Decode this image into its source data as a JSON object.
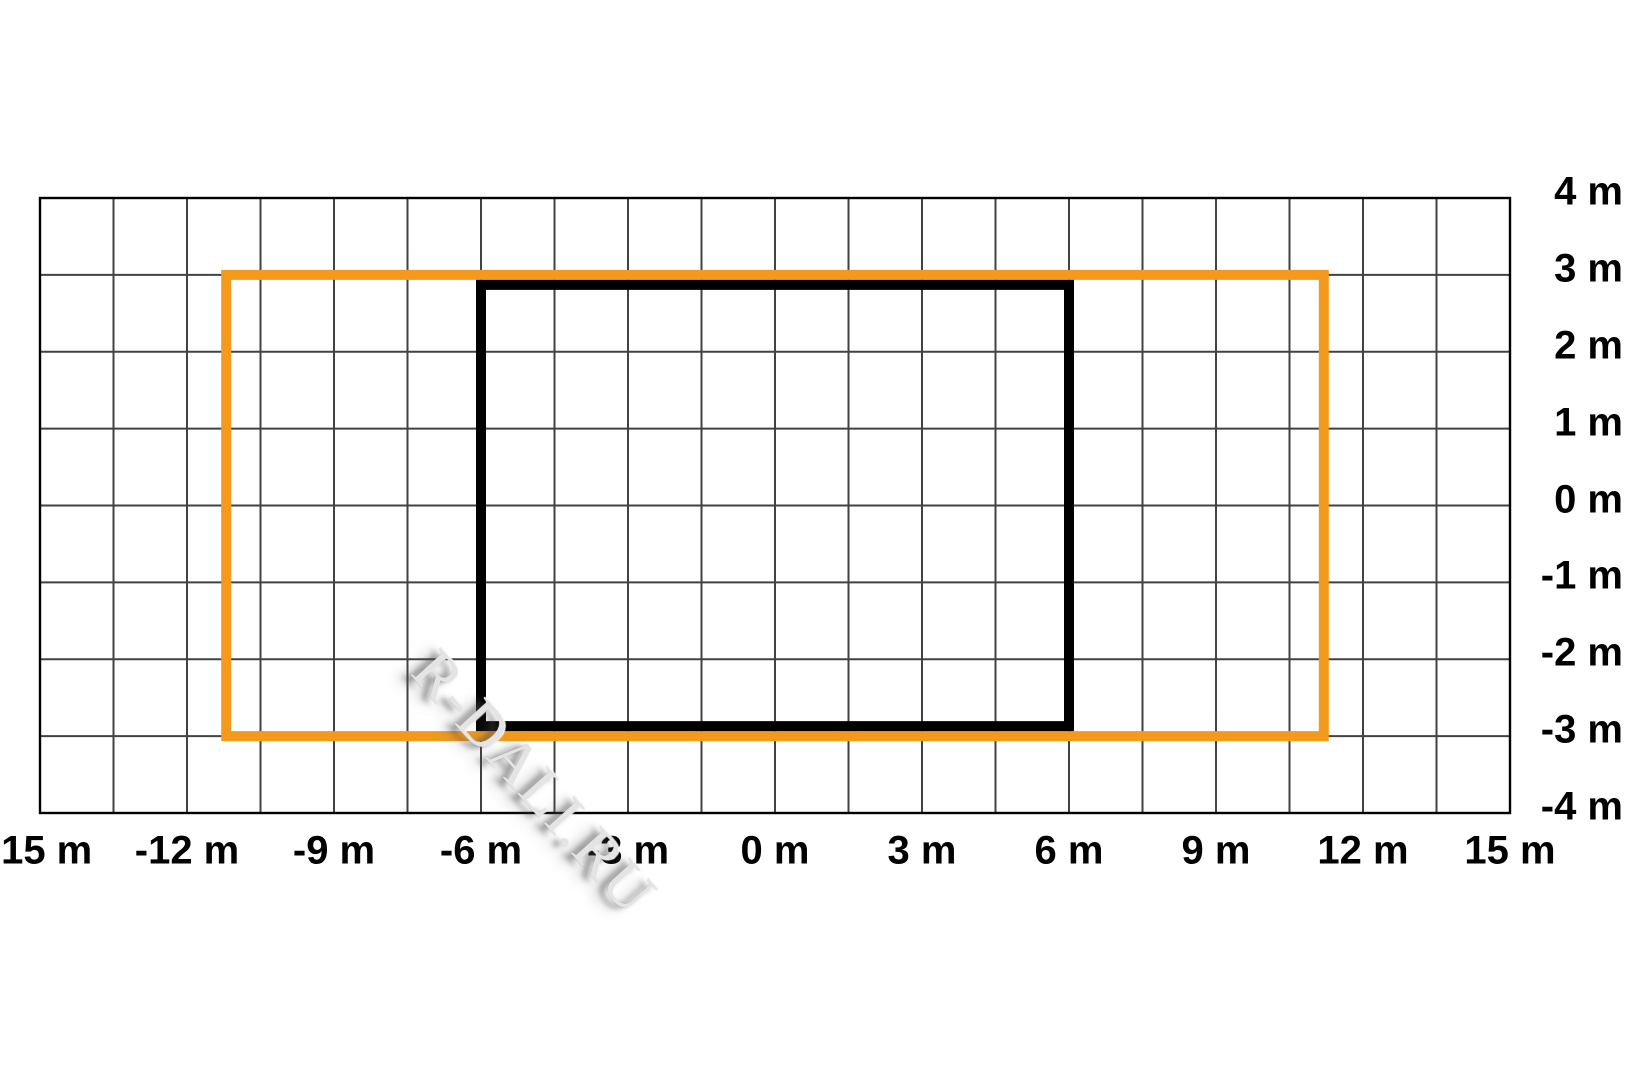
{
  "watermark": {
    "text": "R-DALI.RU"
  },
  "chart_data": {
    "type": "diagram",
    "description": "Top-view placement grid in meters with two nested rectangular outlines: an outer orange rectangle and an inner black rectangle",
    "x_axis": {
      "unit": "m",
      "min": -15,
      "max": 15,
      "tick_step_m": 3,
      "grid_step_m": 1.5,
      "tick_labels": [
        "-15 m",
        "-12 m",
        "-9 m",
        "-6 m",
        "-3 m",
        "0 m",
        "3 m",
        "6 m",
        "9 m",
        "12 m",
        "15 m"
      ]
    },
    "y_axis": {
      "unit": "m",
      "min": -4,
      "max": 4,
      "tick_step_m": 1,
      "grid_step_m": 1,
      "tick_labels": [
        "4 m",
        "3 m",
        "2 m",
        "1 m",
        "0 m",
        "-1 m",
        "-2 m",
        "-3 m",
        "-4 m"
      ]
    },
    "grid": {
      "background": "#FFFFFF",
      "line_color": "#424242",
      "border_color": "#000000"
    },
    "rectangles": [
      {
        "name": "orange-rectangle",
        "x_min_m": -11.2,
        "x_max_m": 11.2,
        "y_min_m": -3,
        "y_max_m": 3,
        "stroke_color": "#F39A1D",
        "stroke_width_px": 10
      },
      {
        "name": "black-rectangle",
        "x_min_m": -6,
        "x_max_m": 6,
        "y_min_m": -2.87,
        "y_max_m": 2.87,
        "stroke_color": "#000000",
        "stroke_width_px": 10
      }
    ]
  }
}
